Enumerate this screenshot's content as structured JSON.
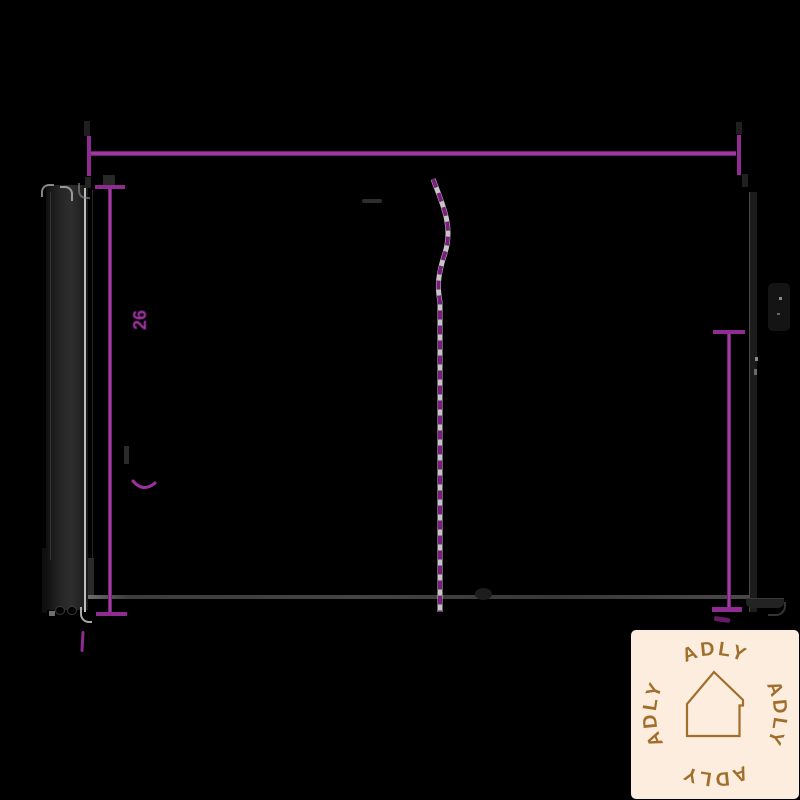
{
  "drawing": {
    "type": "technical-dimension-diagram",
    "left_dimension_label": "26",
    "colors": {
      "background": "#000000",
      "dimension_magenta": "#9b2f9d",
      "centerline_dash": "#7a1f7d",
      "centerline_casing": "#e9e9e9",
      "floor_line_gray": "#454545",
      "ghost_drawing_gray": "#232323"
    }
  },
  "logo": {
    "words": [
      "ADLY",
      "ADLY",
      "ADLY",
      "ADLY"
    ],
    "icon": "house-outline",
    "background": "#fceddf",
    "foreground": "#a06f2b"
  }
}
